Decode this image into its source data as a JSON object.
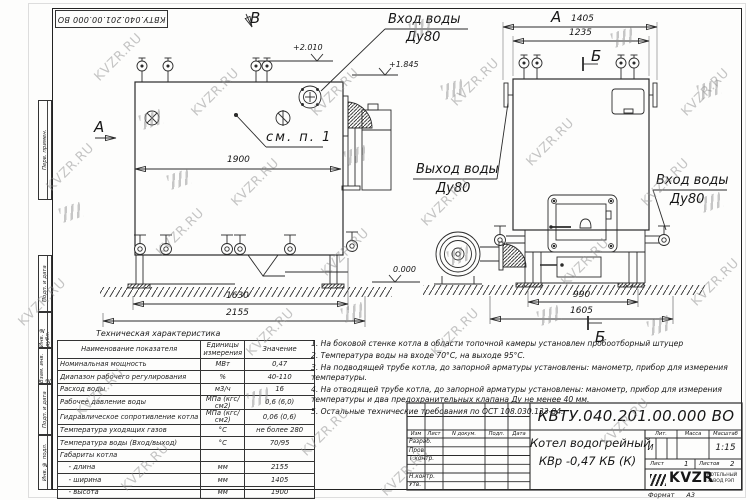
{
  "watermark": {
    "text": "KVZR.RU"
  },
  "stamp_top": "КВТУ.040.201.00.000 ВО",
  "margin_cells": [
    "Перв. примен.",
    "Подп. и дата",
    "Инв. № дубл.",
    "Взам. инв. №",
    "Подп. и дата",
    "Инв. № подл."
  ],
  "drawing": {
    "view_b": "В",
    "view_a_arrow": "А",
    "view_a": "А",
    "see_note": "см. п. 1",
    "inlet_top1": "Вход воды",
    "inlet_top2": "Ду80",
    "outlet1": "Выход воды",
    "outlet2": "Ду80",
    "inlet_r1": "Вход воды",
    "inlet_r2": "Ду80",
    "elev1": "+2.010",
    "elev2": "+1.845",
    "level0": "0.000",
    "dim1900": "1900",
    "dim1630": "1630",
    "dim2155": "2155",
    "dim1405": "1405",
    "dim1235": "1235",
    "dim990": "990",
    "dim1605": "1605",
    "sec_b_top": "Б",
    "sec_b_bot": "Б"
  },
  "tech_table": {
    "title": "Техническая характеристика",
    "headers": [
      "Наименование показателя",
      "Единицы измерения",
      "Значение"
    ],
    "rows": [
      [
        "Номинальная мощность",
        "МВт",
        "0,47"
      ],
      [
        "Диапазон рабочего регулирования",
        "%",
        "40-110"
      ],
      [
        "Расход воды",
        "м3/ч",
        "16"
      ],
      [
        "Рабочее давление воды",
        "МПа (кгс/см2)",
        "0,6 (6,0)"
      ],
      [
        "Гидравлическое сопротивление котла",
        "МПа (кгс/см2)",
        "0,06 (0,6)"
      ],
      [
        "Температура уходящих газов",
        "°С",
        "не более 280"
      ],
      [
        "Температура воды (Вход/выход)",
        "°С",
        "70/95"
      ],
      [
        "Габариты котла",
        "",
        ""
      ],
      [
        "    - длина",
        "мм",
        "2155"
      ],
      [
        "    - ширина",
        "мм",
        "1405"
      ],
      [
        "    - высота",
        "мм",
        "1900"
      ]
    ]
  },
  "notes": [
    "1.  На боковой стенке котла в области топочной камеры установлен пробоотборный штуцер",
    "2.  Температура воды на входе  70°С, на выходе  95°С.",
    "3.  На подводящей трубе котла, до запорной арматуры установлены: манометр, прибор для измерения температуры.",
    "4.  На отводящей трубе котла, до запорной арматуры установлены: манометр, прибор для измерения температуры и два предохранительных клапана  Ду не менее  40 мм.",
    "5.  Остальные технические требования по ОСТ  108.030.133-84."
  ],
  "title_block": {
    "designation": "КВТУ.040.201.00.000  ВО",
    "cols": [
      "Изм",
      "Лист",
      "N докум.",
      "Подп.",
      "Дата"
    ],
    "rows": [
      "Разраб.",
      "Пров.",
      "Т.контр.",
      "Н.контр.",
      "Утв."
    ],
    "name1": "Котел водогрейный",
    "name2": "КВр -0,47 КБ (К)",
    "lit_h": "Лит.",
    "mass_h": "Масса",
    "scale_h": "Масштаб",
    "lit": "И",
    "scale": "1:15",
    "sheet_h": "Лист",
    "sheet": "1",
    "sheets_h": "Листов",
    "sheets": "2",
    "logo": "KVZR",
    "co1": "КОТЕЛЬНЫЙ",
    "co2": "ЗАВОД РЭП",
    "fmt_h": "Формат",
    "fmt": "А3"
  }
}
